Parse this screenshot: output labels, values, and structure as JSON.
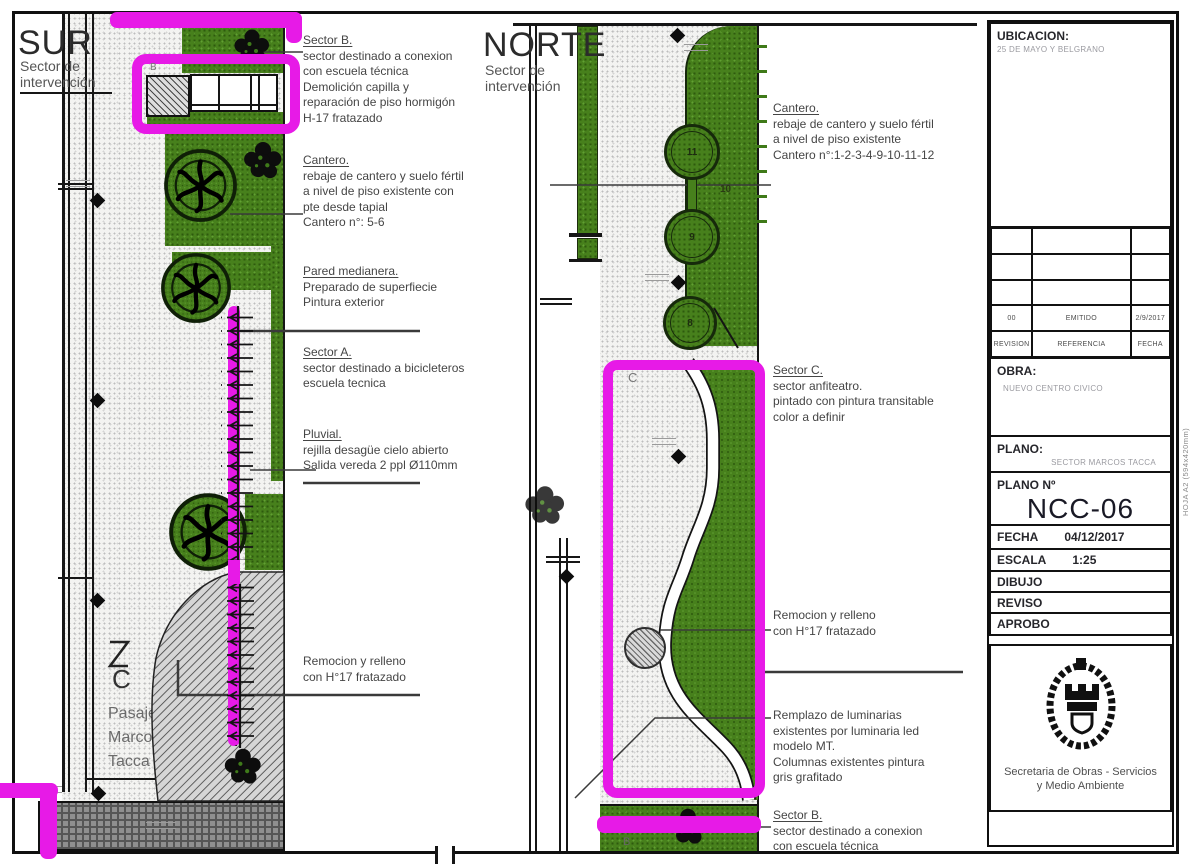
{
  "sur": {
    "title": "SUR",
    "subtitle_1": "Sector de",
    "subtitle_2": "intervención",
    "label_b": "B",
    "label_c": "C",
    "street": [
      "Pasaje",
      "Marcos",
      "Tacca"
    ],
    "ann_sector_b": {
      "title": "Sector B.",
      "lines": [
        "sector destinado a conexion",
        "con escuela técnica",
        "Demolición capilla y",
        "reparación de piso hormigón",
        "H-17 fratazado"
      ]
    },
    "ann_cantero": {
      "title": "Cantero.",
      "lines": [
        "rebaje de cantero y suelo fértil",
        "a nivel de piso existente con",
        "pte desde tapial",
        "Cantero n°: 5-6"
      ]
    },
    "ann_pared": {
      "title": "Pared medianera.",
      "lines": [
        "Preparado de superfiecie",
        "Pintura exterior"
      ]
    },
    "ann_sector_a": {
      "title": "Sector A.",
      "lines": [
        "sector destinado a bicicleteros",
        "escuela tecnica"
      ]
    },
    "ann_pluvial": {
      "title": "Pluvial.",
      "lines": [
        "rejilla desagüe cielo abierto",
        "Salida vereda 2 ppl Ø110mm"
      ]
    },
    "ann_remocion": {
      "lines": [
        "Remocion y relleno",
        "con H°17 fratazado"
      ]
    }
  },
  "norte": {
    "title": "NORTE",
    "subtitle_1": "Sector de",
    "subtitle_2": "intervención",
    "label_c": "C",
    "label_b": "B",
    "cantero_numbers": [
      "11",
      "10",
      "9",
      "8"
    ],
    "ann_cantero": {
      "title": "Cantero.",
      "lines": [
        "rebaje de cantero y suelo fértil",
        "a nivel de piso existente",
        "Cantero n°:1-2-3-4-9-10-11-12"
      ]
    },
    "ann_sector_c": {
      "title": "Sector C.",
      "lines": [
        "sector anfiteatro.",
        "pintado con pintura transitable",
        "color a definir"
      ]
    },
    "ann_remocion": {
      "lines": [
        "Remocion y relleno",
        "con H°17 fratazado"
      ]
    },
    "ann_luminarias": {
      "lines": [
        "Remplazo de luminarias",
        "existentes por luminaria led",
        "modelo MT.",
        "Columnas existentes pintura",
        "gris grafitado"
      ]
    },
    "ann_sector_b": {
      "title": "Sector B.",
      "lines": [
        "sector destinado a conexion",
        "con escuela técnica"
      ]
    }
  },
  "titleblock": {
    "ubicacion_label": "UBICACION:",
    "ubicacion_value": "25 DE MAYO Y BELGRANO",
    "rev_row": {
      "rev": "00",
      "ref": "EMITIDO",
      "fecha": "2/9/2017"
    },
    "rev_header": {
      "rev": "REVISION",
      "ref": "REFERENCIA",
      "fecha": "FECHA"
    },
    "obra_label": "OBRA:",
    "obra_value": "NUEVO CENTRO CIVICO",
    "plano_label": "PLANO:",
    "plano_value": "SECTOR MARCOS TACCA",
    "plano_n_label": "PLANO Nº",
    "plano_n_value": "NCC-06",
    "fecha_label": "FECHA",
    "fecha_value": "04/12/2017",
    "escala_label": "ESCALA",
    "escala_value": "1:25",
    "dibujo_label": "DIBUJO",
    "reviso_label": "REVISO",
    "aprobo_label": "APROBO",
    "secretaria_1": "Secretaria de Obras - Servicios",
    "secretaria_2": "y Medio Ambiente",
    "hoja": "HOJA A2 (594x420mm)"
  },
  "colors": {
    "magenta": "#e71ae7",
    "green": "#47801c",
    "paper": "#ffffff"
  }
}
